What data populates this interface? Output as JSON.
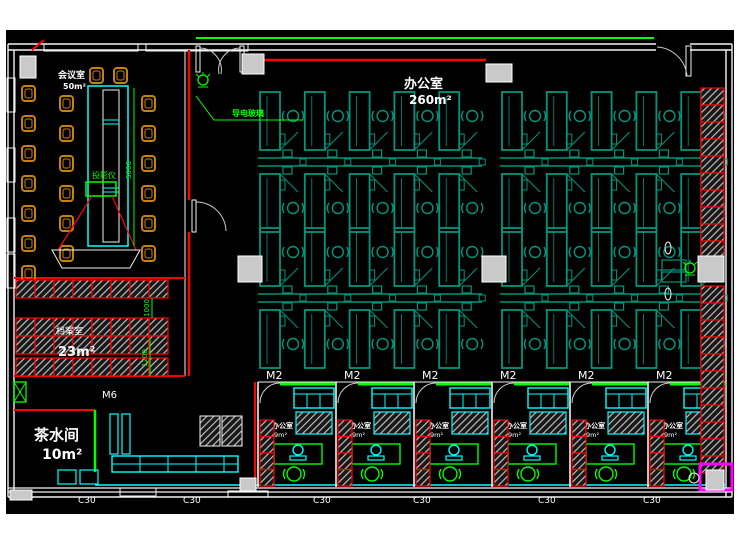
{
  "colors": {
    "background": "#000000",
    "wall_white": "#f2f2f2",
    "accent_red": "#ff0000",
    "accent_green": "#00ff00",
    "cubicle_teal": "#00957c",
    "furniture_cyan": "#00ffff",
    "chair_orange": "#c8820a",
    "column_grey": "#c9c9c9",
    "hatch_grey": "#bdbdbd",
    "corner_magenta": "#ff00ff",
    "label_white": "#ffffff"
  },
  "rooms": {
    "conference": {
      "label": "会议室",
      "area": "50m²"
    },
    "main_office": {
      "label": "办公室",
      "area": "260m²"
    },
    "archive": {
      "label": "档案室",
      "area": "23m²"
    },
    "tea": {
      "label": "茶水间",
      "area": "10m²"
    },
    "small_offices": {
      "label": "办公室",
      "area": "9m²",
      "count": 6,
      "door_tag": "M2"
    }
  },
  "annotations": {
    "glass_wall": "导电玻璃",
    "projector": "投影仪",
    "dim_1000": "1000",
    "dim_1200": "1200",
    "dim_5000": "5000",
    "door_m6": "M6"
  },
  "window_tags": {
    "left": [
      "C12",
      "C08",
      "C08",
      "C12"
    ],
    "bottom": [
      "C30",
      "C30",
      "C30",
      "C30",
      "C30",
      "C30"
    ]
  }
}
